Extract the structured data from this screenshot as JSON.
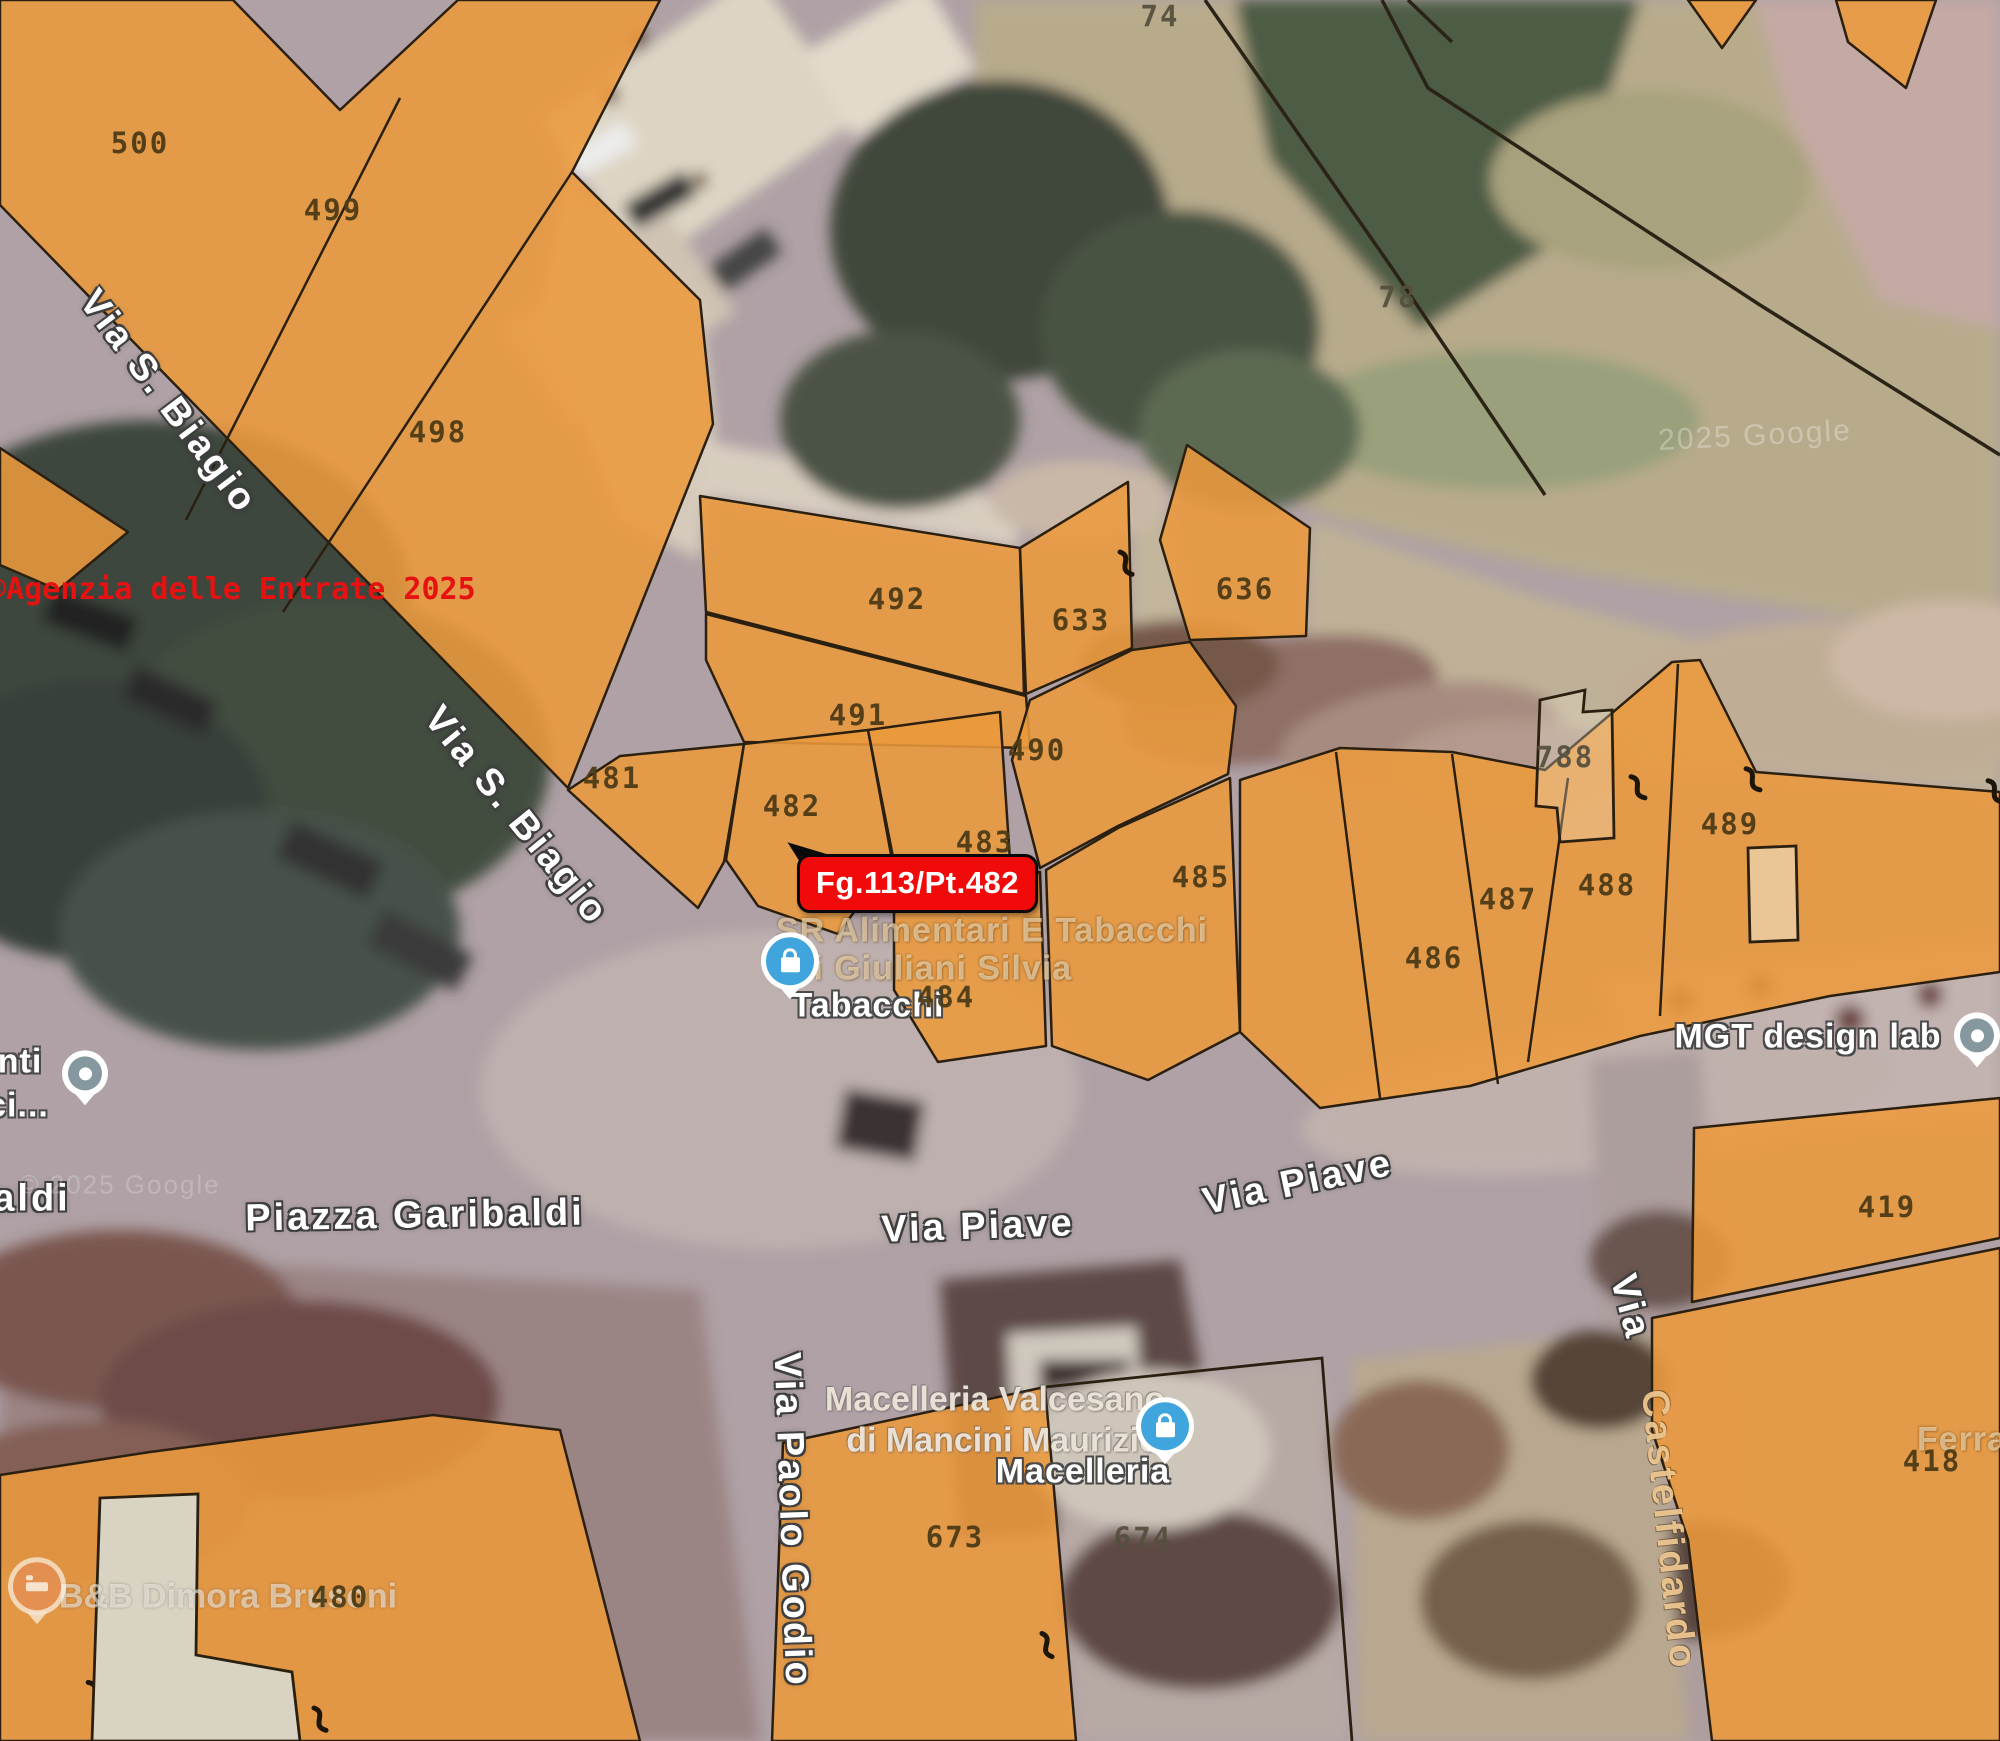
{
  "map": {
    "type": "cadastral-overlay-on-satellite",
    "marker": {
      "label": "Fg.113/Pt.482",
      "x": 797,
      "y": 854
    },
    "watermark_agenzia": {
      "text": "©Agenzia delle Entrate 2025",
      "x": -12,
      "y": 572
    },
    "colors": {
      "parcel_fill": "#EC9A3C",
      "parcel_boundary": "#2B2010",
      "parcel_number": "#4C3B16",
      "parcel_number_on_ground": "#56503F",
      "marker_red": "#F00A0A",
      "marker_text": "#FFFFFF",
      "watermark_red": "#E61212",
      "road_gray": "#AFA1A5",
      "field_khaki": "#B8AB8C"
    },
    "parcel_numbers": [
      {
        "n": "500",
        "x": 140,
        "y": 143,
        "alt": false
      },
      {
        "n": "499",
        "x": 333,
        "y": 210,
        "alt": false
      },
      {
        "n": "498",
        "x": 438,
        "y": 432,
        "alt": false
      },
      {
        "n": "74",
        "x": 1160,
        "y": 16,
        "alt": true
      },
      {
        "n": "78",
        "x": 1398,
        "y": 297,
        "alt": true
      },
      {
        "n": "492",
        "x": 897,
        "y": 599,
        "alt": false
      },
      {
        "n": "633",
        "x": 1081,
        "y": 620,
        "alt": false
      },
      {
        "n": "636",
        "x": 1245,
        "y": 589,
        "alt": false
      },
      {
        "n": "491",
        "x": 858,
        "y": 715,
        "alt": false
      },
      {
        "n": "481",
        "x": 612,
        "y": 778,
        "alt": false
      },
      {
        "n": "482",
        "x": 792,
        "y": 806,
        "alt": false
      },
      {
        "n": "483",
        "x": 985,
        "y": 842,
        "alt": false
      },
      {
        "n": "490",
        "x": 1037,
        "y": 750,
        "alt": false
      },
      {
        "n": "788",
        "x": 1565,
        "y": 757,
        "alt": true
      },
      {
        "n": "489",
        "x": 1730,
        "y": 824,
        "alt": false
      },
      {
        "n": "488",
        "x": 1607,
        "y": 885,
        "alt": false
      },
      {
        "n": "487",
        "x": 1508,
        "y": 899,
        "alt": false
      },
      {
        "n": "486",
        "x": 1434,
        "y": 958,
        "alt": false
      },
      {
        "n": "485",
        "x": 1201,
        "y": 877,
        "alt": false
      },
      {
        "n": "484",
        "x": 946,
        "y": 997,
        "alt": false
      },
      {
        "n": "419",
        "x": 1887,
        "y": 1207,
        "alt": false
      },
      {
        "n": "418",
        "x": 1932,
        "y": 1461,
        "alt": false
      },
      {
        "n": "673",
        "x": 955,
        "y": 1537,
        "alt": false
      },
      {
        "n": "674",
        "x": 1143,
        "y": 1538,
        "alt": true
      },
      {
        "n": "480",
        "x": 340,
        "y": 1597,
        "alt": false
      }
    ],
    "labels": [
      {
        "name": "street-via-s-biagio-upper",
        "text": "Via S. Biagio",
        "x": 168,
        "y": 402,
        "rot": 53,
        "cls": "street"
      },
      {
        "name": "street-via-s-biagio-lower",
        "text": "Via S. Biagio",
        "x": 516,
        "y": 816,
        "rot": 51,
        "cls": "street"
      },
      {
        "name": "street-piazza-garibaldi",
        "text": "Piazza Garibaldi",
        "x": 415,
        "y": 1216,
        "rot": -1,
        "cls": "street"
      },
      {
        "name": "street-via-piave-center",
        "text": "Via Piave",
        "x": 978,
        "y": 1227,
        "rot": -2,
        "cls": "street"
      },
      {
        "name": "street-via-piave-right",
        "text": "Via Piave",
        "x": 1298,
        "y": 1183,
        "rot": -12,
        "cls": "street"
      },
      {
        "name": "street-via-paolo-godio",
        "text": "Via Paolo Godio",
        "x": 792,
        "y": 1520,
        "rot": 88,
        "cls": "street"
      },
      {
        "name": "street-via-castelfidardo-via",
        "text": "Via",
        "x": 1630,
        "y": 1307,
        "rot": 75,
        "cls": "street"
      },
      {
        "name": "street-via-castelfidardo-rest",
        "text": "Castelfidardo",
        "x": 1668,
        "y": 1530,
        "rot": 84,
        "cls": "street tinted-street"
      },
      {
        "name": "street-partial-aldi",
        "text": "aldi",
        "x": 32,
        "y": 1199,
        "rot": 0,
        "cls": "street"
      },
      {
        "name": "poi-mgt-design-lab",
        "text": "MGT design lab",
        "x": 1808,
        "y": 1037,
        "rot": 0,
        "cls": "poi-white",
        "inter": true
      },
      {
        "name": "poi-partial-nti",
        "text": "nti",
        "x": 20,
        "y": 1062,
        "rot": 0,
        "cls": "poi-white",
        "inter": true
      },
      {
        "name": "poi-partial-ci",
        "text": "ci...",
        "x": 18,
        "y": 1106,
        "rot": 0,
        "cls": "poi-white",
        "inter": true
      },
      {
        "name": "poi-sr-alimentari-line1",
        "text": "SR Alimentari E Tabacchi",
        "x": 992,
        "y": 931,
        "rot": 0,
        "cls": "poi-tinted",
        "inter": true
      },
      {
        "name": "poi-sr-alimentari-line2",
        "text": "Di Giuliani Silvia",
        "x": 930,
        "y": 969,
        "rot": 0,
        "cls": "poi-tinted",
        "inter": true
      },
      {
        "name": "poi-tabacchi",
        "text": "Tabacchi",
        "x": 868,
        "y": 1006,
        "rot": 0,
        "cls": "poi-white",
        "inter": true
      },
      {
        "name": "poi-macelleria-line1",
        "text": "Macelleria Valcesano",
        "x": 995,
        "y": 1400,
        "rot": 0,
        "cls": "poi-beige",
        "inter": true
      },
      {
        "name": "poi-macelleria-line2",
        "text": "di Mancini Maurizio",
        "x": 1003,
        "y": 1441,
        "rot": 0,
        "cls": "poi-beige",
        "inter": true
      },
      {
        "name": "poi-macelleria-line3",
        "text": "Macelleria",
        "x": 1083,
        "y": 1472,
        "rot": 0,
        "cls": "poi-white",
        "inter": true
      },
      {
        "name": "poi-bnb-dimora-brusoni",
        "text": "B&B Dimora Brusoni",
        "x": 228,
        "y": 1597,
        "rot": 0,
        "cls": "poi-faint",
        "inter": true
      },
      {
        "name": "poi-partial-ferra",
        "text": "Ferra",
        "x": 1962,
        "y": 1440,
        "rot": 0,
        "cls": "poi-tinted",
        "inter": true
      },
      {
        "name": "watermark-google-topright",
        "text": "2025 Google",
        "x": 1755,
        "y": 436,
        "rot": -3,
        "cls": "wm"
      },
      {
        "name": "watermark-google-left",
        "text": "© 2025 Google",
        "x": 120,
        "y": 1185,
        "rot": 0,
        "cls": "wm wm2"
      }
    ],
    "pins": [
      {
        "name": "shopping-pin-tabacchi",
        "type": "shopping",
        "x": 790,
        "y": 967
      },
      {
        "name": "shopping-pin-macelleria",
        "type": "shopping",
        "x": 1165,
        "y": 1432
      },
      {
        "name": "dot-pin-left",
        "type": "dot",
        "x": 85,
        "y": 1078
      },
      {
        "name": "dot-pin-mgt",
        "type": "dot",
        "x": 1977,
        "y": 1040
      },
      {
        "name": "lodging-pin-bnb",
        "type": "lodging",
        "x": 37,
        "y": 1592
      }
    ]
  }
}
